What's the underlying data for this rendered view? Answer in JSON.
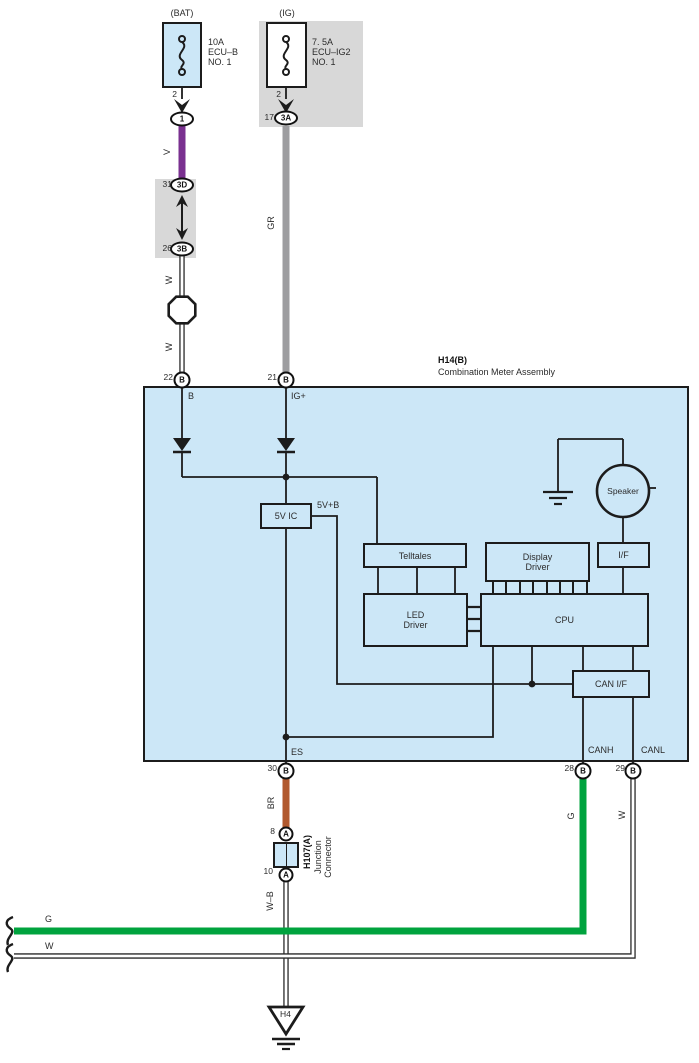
{
  "colors": {
    "panel_blue": "#cce7f7",
    "panel_gray": "#d8d8d8",
    "line": "#1c1c1c",
    "wire_violet": "#7a3190",
    "wire_gray": "#9d9da0",
    "wire_brown": "#b1592e",
    "wire_green": "#00a33e",
    "wire_white_fill": "#ffffff",
    "wire_white_edge": "#2a2a2a"
  },
  "top": {
    "bat": {
      "title": "(BAT)",
      "rating": "10A",
      "name1": "ECU–B",
      "name2": "NO. 1",
      "pin": "2",
      "conn": "1",
      "wire": "V"
    },
    "ig": {
      "title": "(IG)",
      "rating": "7. 5A",
      "name1": "ECU–IG2",
      "name2": "NO. 1",
      "pin": "2",
      "term": "17",
      "conn": "3A",
      "wire": "GR"
    },
    "link": {
      "t31": "31",
      "c3d": "3D",
      "t26": "26",
      "c3b": "3B",
      "wire1": "W",
      "wire2": "W"
    }
  },
  "meter": {
    "code": "H14(B)",
    "name": "Combination Meter Assembly",
    "pin22": {
      "num": "22",
      "id": "B",
      "signal": "B"
    },
    "pin21": {
      "num": "21",
      "id": "B",
      "signal": "IG+"
    },
    "pin30": {
      "num": "30",
      "id": "B",
      "signal": "ES"
    },
    "pin28": {
      "num": "28",
      "id": "B",
      "signal": "CANH"
    },
    "pin29": {
      "num": "29",
      "id": "B",
      "signal": "CANL"
    },
    "ic": "5V IC",
    "rail": "5V+B",
    "telltales": "Telltales",
    "led1": "LED",
    "led2": "Driver",
    "dd1": "Display",
    "dd2": "Driver",
    "cpu": "CPU",
    "speaker": "Speaker",
    "iface": "I/F",
    "can_if": "CAN I/F"
  },
  "bottom": {
    "wire_br": "BR",
    "jc": {
      "pin8": "8",
      "id8": "A",
      "pin10": "10",
      "id10": "A",
      "code": "H107(A)",
      "name1": "Junction",
      "name2": "Connector"
    },
    "wire_wb": "W–B",
    "wire_g_v": "G",
    "wire_w_v": "W",
    "wire_g_h": "G",
    "wire_w_h": "W",
    "ground": "H4"
  }
}
